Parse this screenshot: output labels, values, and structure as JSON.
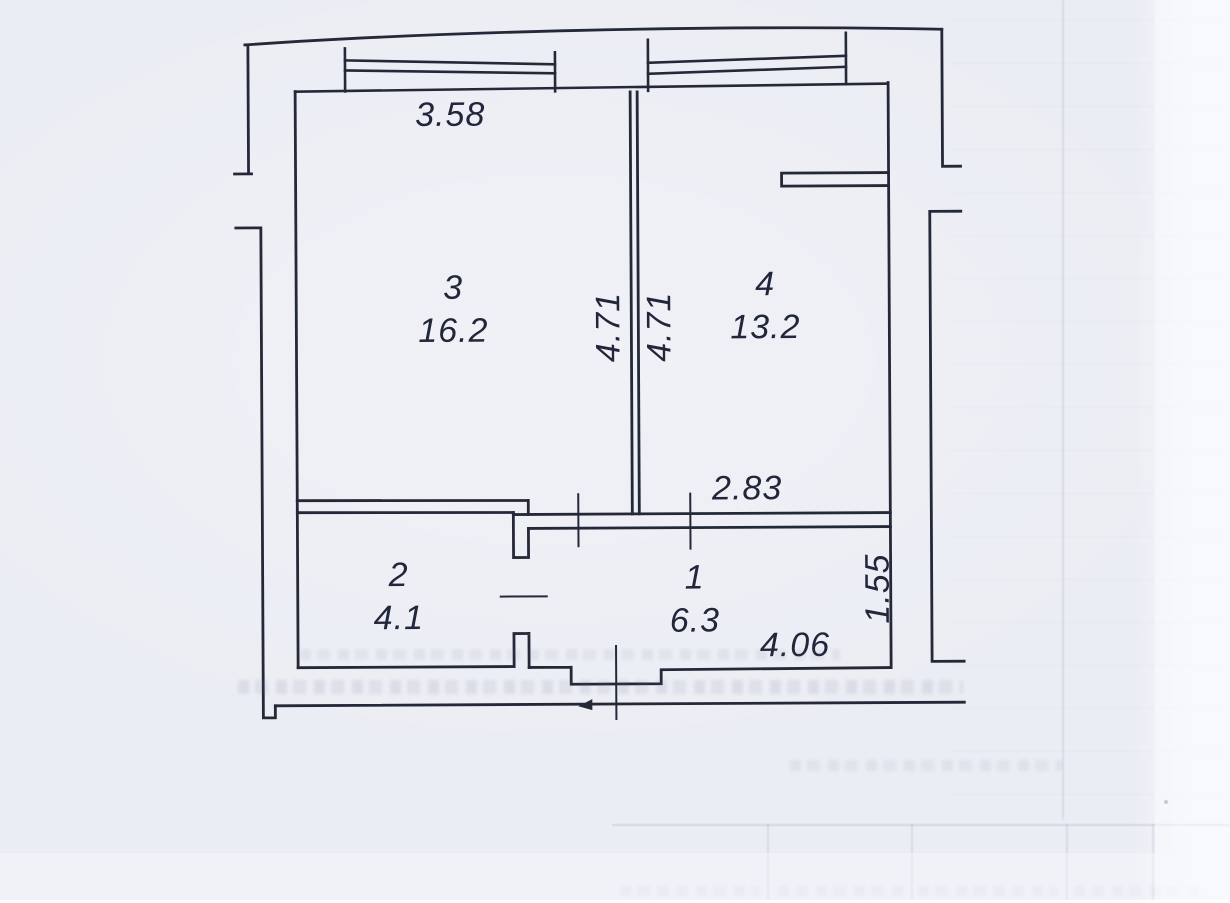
{
  "document": {
    "kind": "scanned apartment floor plan"
  },
  "colors": {
    "paper": "#ebedf4",
    "paper_light": "#f3f4f9",
    "ink": "#242938"
  },
  "rooms": [
    {
      "number": "3",
      "area": "16.2"
    },
    {
      "number": "4",
      "area": "13.2"
    },
    {
      "number": "2",
      "area": "4.1"
    },
    {
      "number": "1",
      "area": "6.3"
    }
  ],
  "dimensions": {
    "top_width": "3.58",
    "partition_left_height": "4.71",
    "partition_right_height": "4.71",
    "hall_top_width": "2.83",
    "hall_bottom_width": "4.06",
    "hall_right_height": "1.55"
  }
}
